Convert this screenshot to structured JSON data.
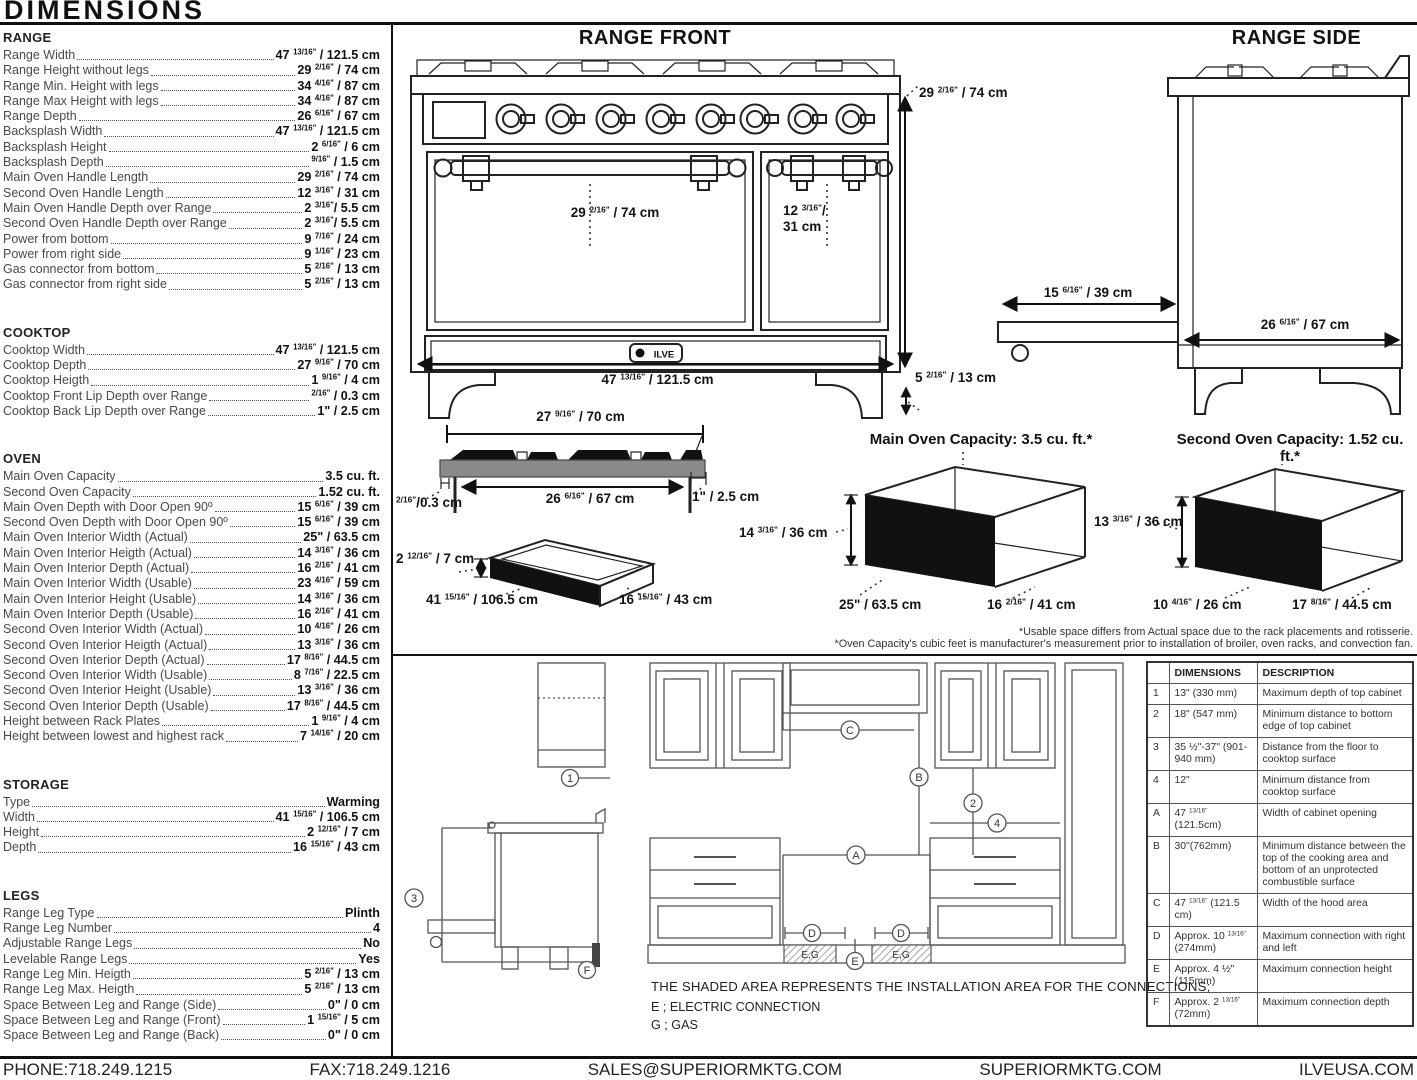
{
  "page_title": "DIMENSIONS",
  "brand": "ILVE",
  "specs": {
    "sections": [
      {
        "title": "RANGE",
        "rows": [
          {
            "label": "Range Width",
            "value": "47 13/16\" / 121.5 cm"
          },
          {
            "label": "Range Height without legs",
            "value": "29 2/16\" / 74 cm"
          },
          {
            "label": "Range Min. Height with legs",
            "value": "34 4/16\" / 87 cm"
          },
          {
            "label": "Range Max Height with legs",
            "value": "34 4/16\" / 87 cm"
          },
          {
            "label": "Range Depth",
            "value": "26 6/16\" / 67 cm"
          },
          {
            "label": "Backsplash Width",
            "value": "47 13/16\" / 121.5 cm"
          },
          {
            "label": "Backsplash Height",
            "value": "2 6/16\" / 6 cm"
          },
          {
            "label": "Backsplash Depth",
            "value": "9/16\" / 1.5 cm"
          },
          {
            "label": "Main Oven Handle Length",
            "value": "29 2/16\" / 74 cm"
          },
          {
            "label": "Second Oven Handle Length",
            "value": "12 3/16\" / 31 cm"
          },
          {
            "label": "Main Oven Handle Depth over Range",
            "value": "2 3/16\"/ 5.5 cm"
          },
          {
            "label": "Second Oven Handle Depth over Range",
            "value": "2 3/16\"/ 5.5 cm"
          },
          {
            "label": "Power from bottom",
            "value": "9 7/16\" / 24 cm"
          },
          {
            "label": "Power from right side",
            "value": "9 1/16\" / 23 cm"
          },
          {
            "label": "Gas connector from bottom",
            "value": "5 2/16\" / 13 cm"
          },
          {
            "label": "Gas connector from right side",
            "value": "5 2/16\" / 13 cm"
          }
        ]
      },
      {
        "title": "COOKTOP",
        "rows": [
          {
            "label": "Cooktop Width",
            "value": "47 13/16\" / 121.5 cm"
          },
          {
            "label": "Cooktop Depth",
            "value": "27 9/16\" / 70 cm"
          },
          {
            "label": "Cooktop Heigth",
            "value": "1 9/16\" / 4 cm"
          },
          {
            "label": "Cooktop Front Lip Depth over Range",
            "value": "2/16\" / 0.3 cm"
          },
          {
            "label": "Cooktop Back Lip Depth over Range",
            "value": "1\" / 2.5 cm"
          }
        ]
      },
      {
        "title": "OVEN",
        "rows": [
          {
            "label": "Main Oven Capacity",
            "value": "3.5 cu. ft."
          },
          {
            "label": "Second Oven Capacity",
            "value": "1.52 cu. ft."
          },
          {
            "label": "Main Oven Depth with Door Open 90º",
            "value": "15 6/16\" / 39 cm"
          },
          {
            "label": "Second Oven Depth with Door Open 90º",
            "value": "15 6/16\" / 39 cm"
          },
          {
            "label": "Main Oven Interior Width (Actual)",
            "value": "25\" / 63.5 cm"
          },
          {
            "label": "Main Oven Interior Heigth (Actual)",
            "value": "14 3/16\" / 36 cm"
          },
          {
            "label": "Main Oven Interior Depth (Actual)",
            "value": "16 2/16\" / 41 cm"
          },
          {
            "label": "Main Oven Interior Width (Usable)",
            "value": "23 4/16\" / 59 cm"
          },
          {
            "label": "Main Oven Interior Height (Usable)",
            "value": "14 3/16\" / 36 cm"
          },
          {
            "label": "Main Oven Interior Depth (Usable)",
            "value": "16 2/16\" / 41 cm"
          },
          {
            "label": "Second Oven Interior Width (Actual)",
            "value": "10 4/16\" / 26 cm"
          },
          {
            "label": "Second Oven Interior Heigth (Actual)",
            "value": "13 3/16\" / 36 cm"
          },
          {
            "label": "Second Oven Interior Depth (Actual)",
            "value": "17 8/16\" / 44.5 cm"
          },
          {
            "label": "Second Oven Interior Width (Usable)",
            "value": "8 7/16\" / 22.5 cm"
          },
          {
            "label": "Second Oven Interior Height (Usable)",
            "value": "13 3/16\" / 36 cm"
          },
          {
            "label": "Second Oven Interior Depth (Usable)",
            "value": "17 8/16\" / 44.5 cm"
          },
          {
            "label": "Height between Rack Plates",
            "value": "1 9/16\" / 4 cm"
          },
          {
            "label": "Height between lowest and highest rack",
            "value": "7 14/16\" / 20 cm"
          }
        ]
      },
      {
        "title": "STORAGE",
        "rows": [
          {
            "label": "Type",
            "value": "Warming"
          },
          {
            "label": "Width",
            "value": "41 15/16\" / 106.5 cm"
          },
          {
            "label": "Height",
            "value": "2 12/16\" / 7 cm"
          },
          {
            "label": "Depth",
            "value": "16 15/16\" / 43 cm"
          }
        ]
      },
      {
        "title": "LEGS",
        "rows": [
          {
            "label": "Range Leg Type",
            "value": "Plinth"
          },
          {
            "label": "Range Leg Number",
            "value": "4"
          },
          {
            "label": "Adjustable Range Legs",
            "value": "No"
          },
          {
            "label": "Levelable Range Legs",
            "value": "Yes"
          },
          {
            "label": "Range Leg Min. Heigth",
            "value": "5 2/16\" / 13 cm"
          },
          {
            "label": "Range Leg Max. Heigth",
            "value": "5 2/16\" / 13 cm"
          },
          {
            "label": "Space Between Leg and Range (Side)",
            "value": "0\" / 0 cm"
          },
          {
            "label": "Space Between Leg and Range (Front)",
            "value": "1 15/16\" / 5 cm"
          },
          {
            "label": "Space Between Leg and Range (Back)",
            "value": "0\" / 0 cm"
          }
        ]
      }
    ]
  },
  "front_view": {
    "title": "RANGE FRONT",
    "height": "29 2/16\" / 74 cm",
    "main_handle": "29 2/16\" / 74 cm",
    "second_handle": "12 3/16\"/\n31 cm",
    "width": "47 13/16\" / 121.5 cm",
    "leg_height": "5 2/16\" / 13 cm"
  },
  "side_view": {
    "title": "RANGE SIDE",
    "door_open_depth": "15 6/16\" / 39 cm",
    "depth": "26 6/16\" / 67 cm"
  },
  "cooktop_view": {
    "width": "27 9/16\" / 70 cm",
    "inner_width": "26 6/16\" / 67 cm",
    "front_lip": "2/16\"/0.3 cm",
    "back_lip": "1\" / 2.5 cm"
  },
  "storage_view": {
    "height": "2 12/16\" / 7 cm",
    "width": "41 15/16\" / 106.5 cm",
    "depth": "16 15/16\" / 43 cm"
  },
  "main_oven_view": {
    "title": "Main Oven Capacity: 3.5 cu. ft.*",
    "height": "14 3/16\" / 36 cm",
    "width": "25\" / 63.5 cm",
    "depth": "16 2/16\" / 41 cm"
  },
  "second_oven_view": {
    "title": "Second Oven Capacity: 1.52 cu. ft.*",
    "height": "13 3/16\" / 36 cm",
    "width": "10 4/16\" / 26 cm",
    "depth": "17 8/16\" / 44.5 cm"
  },
  "footnotes": [
    "*Usable space differs from Actual space due to the rack placements and rotisserie.",
    "*Oven Capacity's cubic feet is manufacturer's measurement prior to installation of broiler, oven racks, and convection fan."
  ],
  "install": {
    "note": "THE SHADED AREA REPRESENTS THE INSTALLATION AREA FOR THE CONNECTIONS;",
    "legend_e": "E ; ELECTRIC CONNECTION",
    "legend_g": "G ; GAS",
    "markers": {
      "n1": "1",
      "n2": "2",
      "n3": "3",
      "n4": "4",
      "a": "A",
      "b": "B",
      "c": "C",
      "d": "D",
      "e": "E",
      "f": "F",
      "eg": "E,G"
    }
  },
  "install_table": {
    "headers": [
      "",
      "DIMENSIONS",
      "DESCRIPTION"
    ],
    "rows": [
      [
        "1",
        "13\" (330 mm)",
        "Maximum depth of top cabinet"
      ],
      [
        "2",
        "18\" (547 mm)",
        "Minimum distance to bottom edge of top cabinet"
      ],
      [
        "3",
        "35 ½\"-37\" (901-940 mm)",
        "Distance from the floor to cooktop surface"
      ],
      [
        "4",
        "12\"",
        "Minimum distance from cooktop surface"
      ],
      [
        "A",
        "47 13/16\"(121.5cm)",
        "Width of cabinet opening"
      ],
      [
        "B",
        "30\"(762mm)",
        "Minimum distance between the top of the cooking area and bottom of an unprotected combustible surface"
      ],
      [
        "C",
        "47 13/16\" (121.5 cm)",
        "Width of the hood area"
      ],
      [
        "D",
        "Approx. 10 13/16\" (274mm)",
        "Maximum connection with right and left"
      ],
      [
        "E",
        "Approx. 4 ½\" (115mm)",
        "Maximum connection height"
      ],
      [
        "F",
        "Approx. 2 13/16\" (72mm)",
        "Maximum connection depth"
      ]
    ]
  },
  "footer": {
    "phone": "PHONE:718.249.1215",
    "fax": "FAX:718.249.1216",
    "email": "SALES@SUPERIORMKTG.COM",
    "site": "SUPERIORMKTG.COM",
    "site2": "ILVEUSA.COM"
  }
}
